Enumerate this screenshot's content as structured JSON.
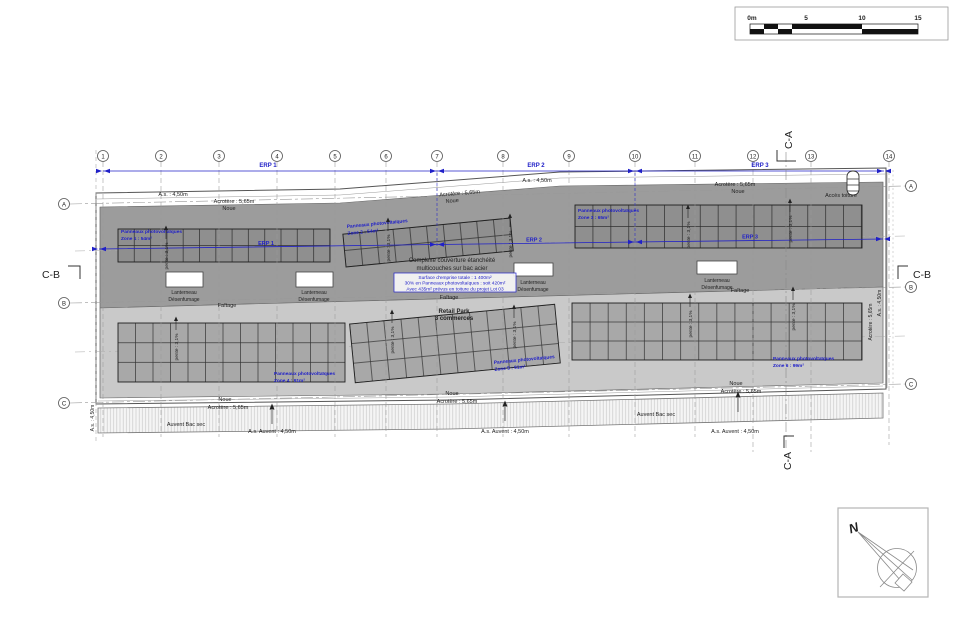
{
  "scale_bar": {
    "ticks": [
      "0m",
      "5",
      "10",
      "15"
    ]
  },
  "grid": {
    "columns": [
      "1",
      "2",
      "3",
      "4",
      "5",
      "6",
      "7",
      "8",
      "9",
      "10",
      "11",
      "12",
      "13",
      "14"
    ]
  },
  "erp": {
    "e1": "ERP 1",
    "e2": "ERP 2",
    "e3": "ERP 3"
  },
  "rows": {
    "a": "A",
    "b": "B",
    "c": "C"
  },
  "sections": {
    "ca": "C-A",
    "cb": "C-B"
  },
  "labels": {
    "as": "A.s. : 4,50m",
    "acrotere": "Acrotère : 5,65m",
    "noue": "Noue",
    "acces": "Accès toiture",
    "faitage": "Faîtage",
    "lant1": "Lanterneau",
    "lant2": "Désenfumage",
    "pente": "pente : 3,1%",
    "auvent": "Auvent Bac sec",
    "as_auvent": "A.s. Auvent : 4,50m",
    "north": "N"
  },
  "note": {
    "l1": "Complexe couverture étanchéité",
    "l2": "multicouches sur bac acier"
  },
  "surface_box": {
    "l1": "Surface d'emprise totale : 1 400m²",
    "l2": "30% en Panneaux photovoltaïques : soit 420m²",
    "l3": "Avec 435m² prévus en toiture du projet Lot 03"
  },
  "retail": {
    "l1": "Retail Park",
    "l2": "3 commerces"
  },
  "zones": [
    {
      "t": "Panneaux photovoltaïques",
      "s": "Zone 1 : 54m²"
    },
    {
      "t": "Panneaux photovoltaïques",
      "s": "Zone 2 : 54m²"
    },
    {
      "t": "Panneaux photovoltaïques",
      "s": "Zone 3 : 65m²"
    },
    {
      "t": "Panneaux photovoltaïques",
      "s": "Zone 4 : 91m²"
    },
    {
      "t": "Panneaux photovoltaïques",
      "s": "Zone 5 : 91m²"
    },
    {
      "t": "Panneaux photovoltaïques",
      "s": "Zone 6 : 99m²"
    }
  ],
  "colors": {
    "blue": "#2020c8",
    "roof_dark": "#9c9c9c",
    "roof_light": "#c9c9c9",
    "panel_dark": "#8f8f8f",
    "panel_light": "#a8a8a8"
  }
}
